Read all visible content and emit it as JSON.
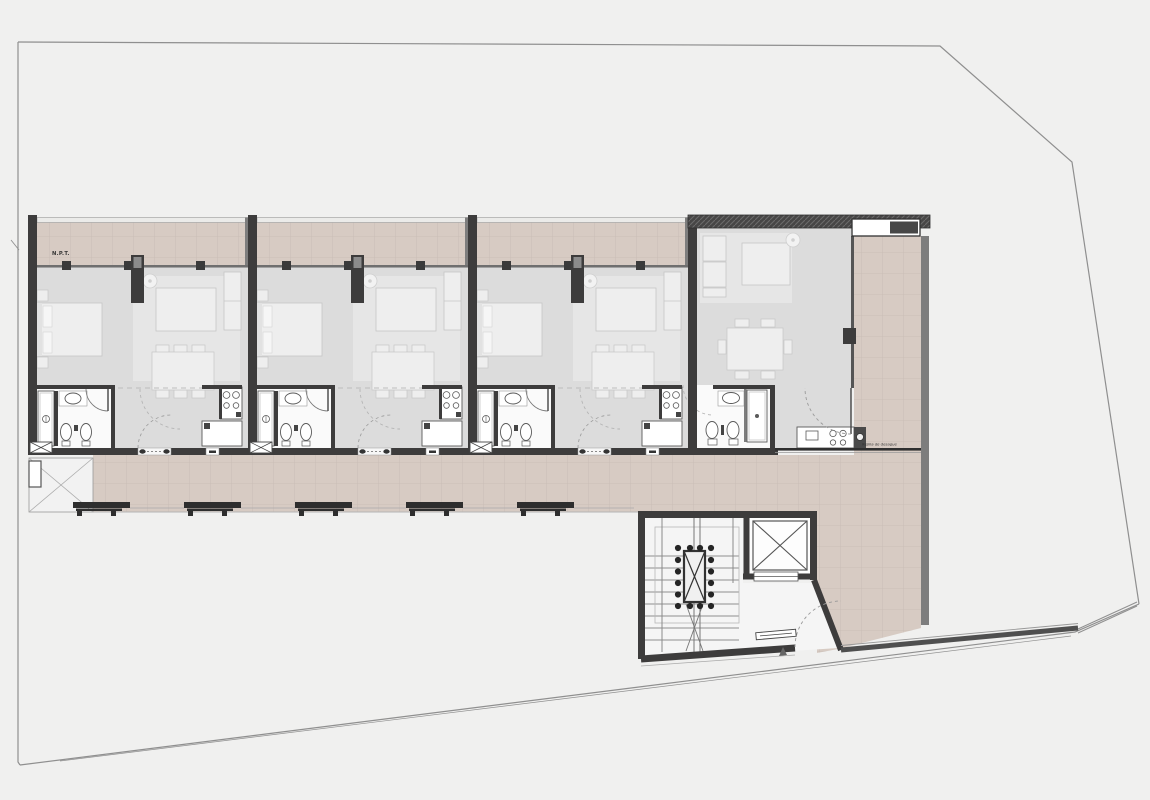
{
  "plan": {
    "floor_level_label": "N.P.T.",
    "drain_label": "Rejilla de desague"
  },
  "colors": {
    "background": "#f0f0ef",
    "tile": "#d7cbc3",
    "tile_line": "#c7bbb4",
    "wall_dark": "#3d3c3c",
    "wall_medium": "#7d7d7d",
    "interior": "#dcdcdc",
    "rug": "#e6e6e6",
    "furniture": "#eeeeee",
    "furniture_line": "#c6c6c6",
    "fixture": "#fafafa",
    "fixture_line": "#5a5a5a",
    "boundary": "#8f8f8f",
    "dashed": "#bdbdbd",
    "core_floor": "#f5f5f5",
    "label_text": "#333333"
  }
}
